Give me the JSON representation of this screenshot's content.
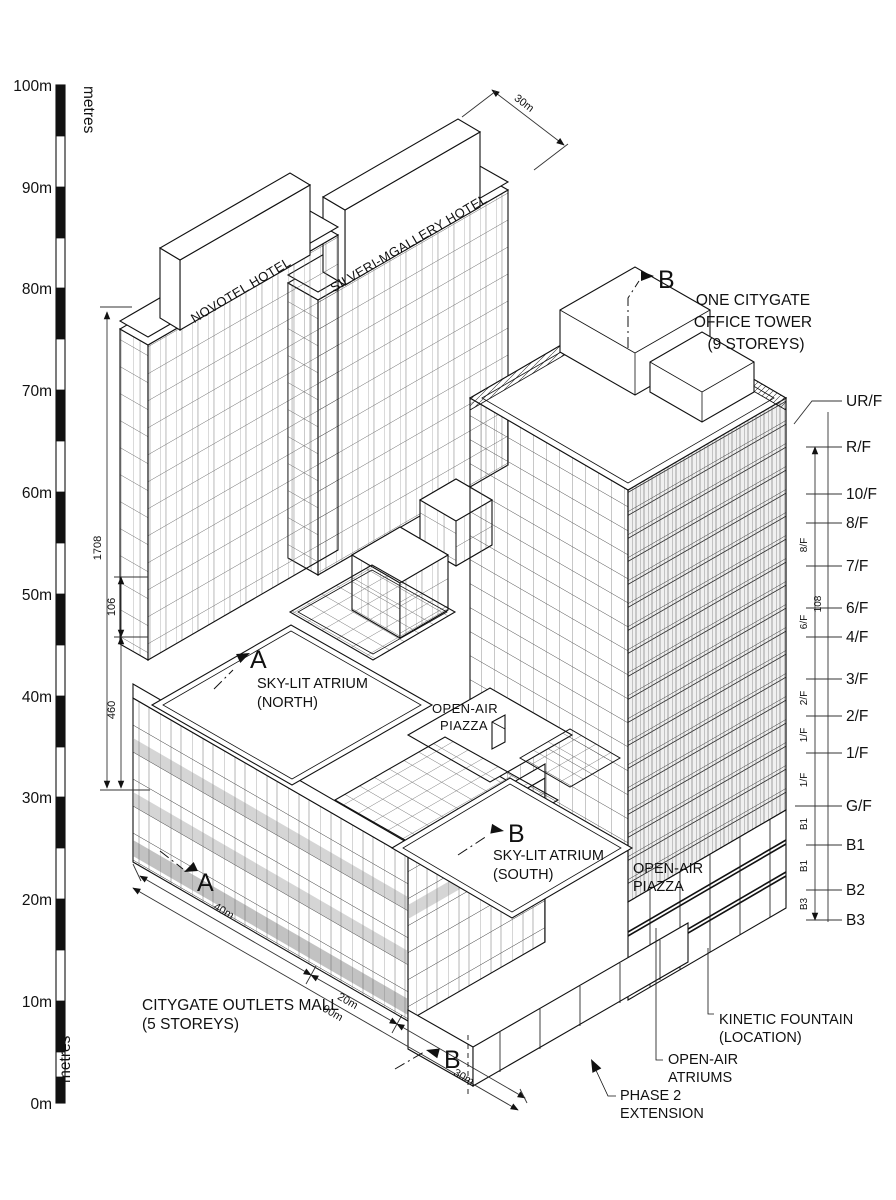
{
  "scale_bar": {
    "unit_top": "metres",
    "unit_bottom": "metres",
    "ticks": [
      "100m",
      "90m",
      "80m",
      "70m",
      "60m",
      "50m",
      "40m",
      "30m",
      "20m",
      "10m",
      "0m"
    ]
  },
  "buildings": {
    "novotel": {
      "label": "NOVOTEL HOTEL"
    },
    "silveri": {
      "label": "SILVERI-MGALLERY HOTEL"
    },
    "office": {
      "line1": "ONE CITYGATE",
      "line2": "OFFICE TOWER",
      "line3": "(9 STOREYS)"
    },
    "mall": {
      "line1": "CITYGATE OUTLETS MALL",
      "line2": "(5 STOREYS)"
    }
  },
  "annotations": {
    "atrium_north": {
      "line1": "SKY-LIT ATRIUM",
      "line2": "(NORTH)"
    },
    "atrium_south": {
      "line1": "SKY-LIT ATRIUM",
      "line2": "(SOUTH)"
    },
    "piazza_center": {
      "line1": "OPEN-AIR",
      "line2": "PIAZZA"
    },
    "piazza_east": {
      "line1": "OPEN-AIR",
      "line2": "PIAZZA"
    },
    "kinetic": {
      "line1": "KINETIC FOUNTAIN",
      "line2": "(LOCATION)"
    },
    "atriums": {
      "line1": "OPEN-AIR",
      "line2": "ATRIUMS"
    },
    "phase2": {
      "line1": "PHASE 2",
      "line2": "EXTENSION"
    }
  },
  "markers": {
    "a": "A",
    "b": "B"
  },
  "dimensions": {
    "top": "30m",
    "bottom_seg1": "40m",
    "bottom_seg2": "20m",
    "bottom_overall": "90m",
    "bottom_seg3": "30m",
    "left_overall": "1708",
    "left_upper": "106",
    "left_lower": "460",
    "right_mid": "108"
  },
  "floors": {
    "labels": [
      "UR/F",
      "R/F",
      "10/F",
      "8/F",
      "7/F",
      "6/F",
      "4/F",
      "3/F",
      "2/F",
      "1/F",
      "G/F",
      "B1",
      "B2",
      "B3"
    ],
    "segment_labels": [
      "8/F",
      "6/F",
      "2/F",
      "1/F",
      "1/F",
      "B1",
      "B1",
      "B3"
    ]
  },
  "colors": {
    "ink": "#111111",
    "shade": "#888888",
    "paper": "#ffffff"
  }
}
